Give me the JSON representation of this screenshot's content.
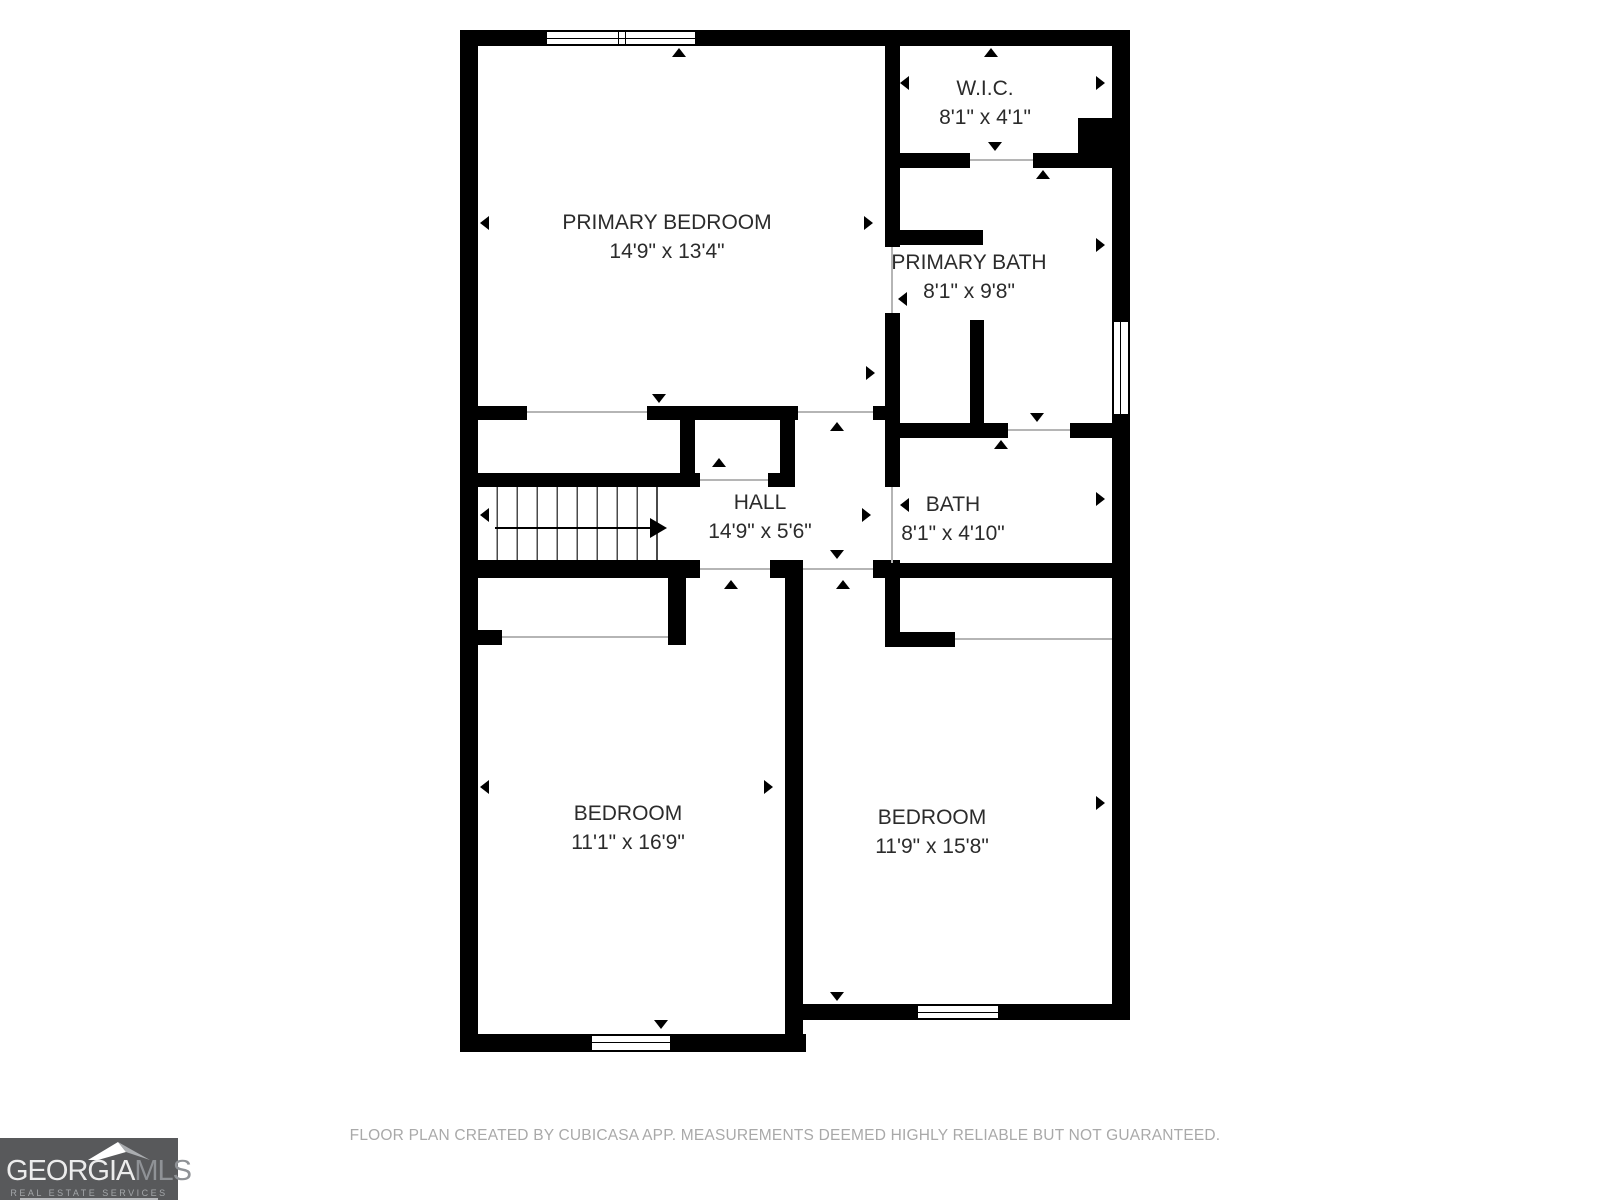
{
  "rooms": [
    {
      "name": "PRIMARY BEDROOM",
      "dims": "14'9\" x 13'4\""
    },
    {
      "name": "W.I.C.",
      "dims": "8'1\" x 4'1\""
    },
    {
      "name": "PRIMARY BATH",
      "dims": "8'1\" x 9'8\""
    },
    {
      "name": "HALL",
      "dims": "14'9\" x 5'6\""
    },
    {
      "name": "BATH",
      "dims": "8'1\" x 4'10\""
    },
    {
      "name": "BEDROOM",
      "dims": "11'1\" x 16'9\""
    },
    {
      "name": "BEDROOM",
      "dims": "11'9\" x 15'8\""
    }
  ],
  "footer": {
    "disclaimer": "FLOOR PLAN CREATED BY CUBICASA APP. MEASUREMENTS DEEMED HIGHLY RELIABLE BUT NOT GUARANTEED."
  },
  "logo": {
    "brand_primary": "GEORGIA",
    "brand_secondary": "MLS",
    "tagline": "REAL ESTATE SERVICES"
  },
  "colors": {
    "wall": "#000000",
    "logo_bg": "#58595b",
    "footer_text": "#a9a9a9"
  }
}
